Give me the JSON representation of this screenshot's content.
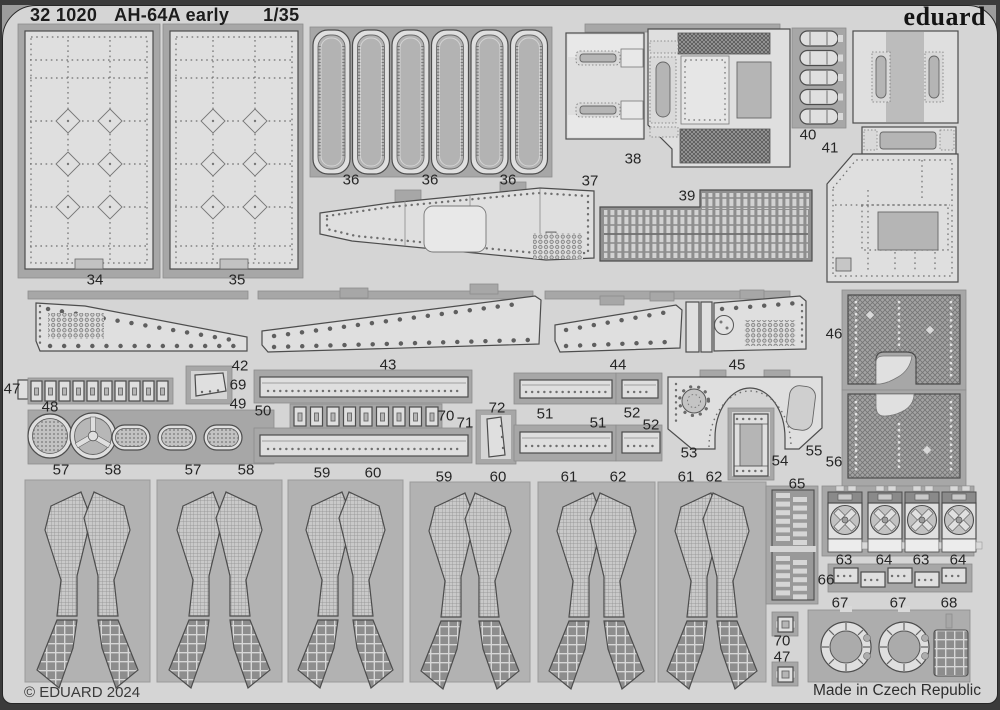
{
  "header": {
    "catalog": "32 1020",
    "title": "AH-64A early",
    "scale": "1/35",
    "brand": "eduard"
  },
  "footer": {
    "copyright": "© EDUARD 2024",
    "made_in": "Made in Czech Republic"
  },
  "colors": {
    "sheet": "#d5d5d5",
    "carrier": "#a7a7a7",
    "part_fill": "#dfdfdf",
    "outline": "#4d4d4d",
    "edge": "#3b3b3b",
    "label_text": "#262626"
  },
  "part_labels": [
    {
      "t": "34",
      "x": 95,
      "y": 280
    },
    {
      "t": "35",
      "x": 237,
      "y": 280
    },
    {
      "t": "36",
      "x": 351,
      "y": 180
    },
    {
      "t": "36",
      "x": 430,
      "y": 180
    },
    {
      "t": "36",
      "x": 508,
      "y": 180
    },
    {
      "t": "37",
      "x": 590,
      "y": 181
    },
    {
      "t": "38",
      "x": 633,
      "y": 159
    },
    {
      "t": "39",
      "x": 687,
      "y": 196
    },
    {
      "t": "40",
      "x": 808,
      "y": 135
    },
    {
      "t": "41",
      "x": 830,
      "y": 148
    },
    {
      "t": "42",
      "x": 240,
      "y": 366
    },
    {
      "t": "43",
      "x": 388,
      "y": 365
    },
    {
      "t": "44",
      "x": 618,
      "y": 365
    },
    {
      "t": "45",
      "x": 737,
      "y": 365
    },
    {
      "t": "46",
      "x": 834,
      "y": 334
    },
    {
      "t": "47",
      "x": 12,
      "y": 389
    },
    {
      "t": "48",
      "x": 50,
      "y": 407
    },
    {
      "t": "69",
      "x": 238,
      "y": 385
    },
    {
      "t": "49",
      "x": 238,
      "y": 404
    },
    {
      "t": "50",
      "x": 263,
      "y": 411
    },
    {
      "t": "70",
      "x": 446,
      "y": 416
    },
    {
      "t": "71",
      "x": 465,
      "y": 423
    },
    {
      "t": "72",
      "x": 497,
      "y": 408
    },
    {
      "t": "51",
      "x": 545,
      "y": 414
    },
    {
      "t": "52",
      "x": 632,
      "y": 413
    },
    {
      "t": "51",
      "x": 598,
      "y": 423
    },
    {
      "t": "52",
      "x": 651,
      "y": 425
    },
    {
      "t": "53",
      "x": 689,
      "y": 453
    },
    {
      "t": "54",
      "x": 780,
      "y": 461
    },
    {
      "t": "55",
      "x": 814,
      "y": 451
    },
    {
      "t": "56",
      "x": 834,
      "y": 462
    },
    {
      "t": "57",
      "x": 61,
      "y": 470
    },
    {
      "t": "58",
      "x": 113,
      "y": 470
    },
    {
      "t": "57",
      "x": 193,
      "y": 470
    },
    {
      "t": "58",
      "x": 246,
      "y": 470
    },
    {
      "t": "59",
      "x": 322,
      "y": 473
    },
    {
      "t": "60",
      "x": 373,
      "y": 473
    },
    {
      "t": "59",
      "x": 444,
      "y": 477
    },
    {
      "t": "60",
      "x": 498,
      "y": 477
    },
    {
      "t": "61",
      "x": 569,
      "y": 477
    },
    {
      "t": "62",
      "x": 618,
      "y": 477
    },
    {
      "t": "61",
      "x": 686,
      "y": 477
    },
    {
      "t": "62",
      "x": 714,
      "y": 477
    },
    {
      "t": "65",
      "x": 797,
      "y": 484
    },
    {
      "t": "63",
      "x": 844,
      "y": 560
    },
    {
      "t": "64",
      "x": 884,
      "y": 560
    },
    {
      "t": "63",
      "x": 921,
      "y": 560
    },
    {
      "t": "64",
      "x": 958,
      "y": 560
    },
    {
      "t": "66",
      "x": 826,
      "y": 580
    },
    {
      "t": "67",
      "x": 840,
      "y": 603
    },
    {
      "t": "67",
      "x": 898,
      "y": 603
    },
    {
      "t": "68",
      "x": 949,
      "y": 603
    },
    {
      "t": "70",
      "x": 782,
      "y": 641
    },
    {
      "t": "47",
      "x": 782,
      "y": 657
    }
  ]
}
